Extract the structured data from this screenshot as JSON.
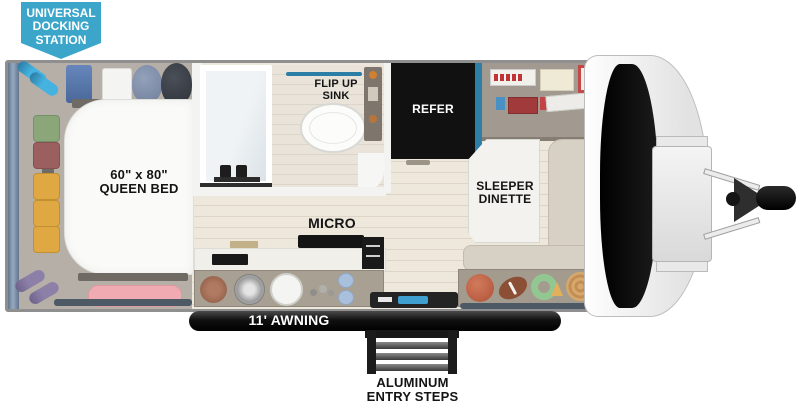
{
  "badge": {
    "line1": "UNIVERSAL",
    "line2": "DOCKING",
    "line3": "STATION"
  },
  "bedroom": {
    "bed_size": "60\" x 80\"",
    "bed_name": "QUEEN BED"
  },
  "bathroom": {
    "sink_line1": "FLIP UP",
    "sink_line2": "SINK"
  },
  "kitchen": {
    "micro_label": "MICRO"
  },
  "living": {
    "refer_label": "REFER",
    "dinette_line1": "SLEEPER",
    "dinette_line2": "DINETTE"
  },
  "exterior": {
    "awning_label": "11' AWNING",
    "steps_line1": "ALUMINUM",
    "steps_line2": "ENTRY STEPS",
    "brand": "SERENOVA"
  },
  "palette": {
    "badge_teal": "#3BA6C9",
    "accent_blue": "#2E7FA6",
    "refer_black": "#111111",
    "floor_wood": "#EDE7DC",
    "bedroom_gray": "#B5AFA7",
    "bench_tan": "#D7D0C4",
    "awning_black": "#1C1C1C",
    "bolster_pink": "#F0ABB2"
  }
}
